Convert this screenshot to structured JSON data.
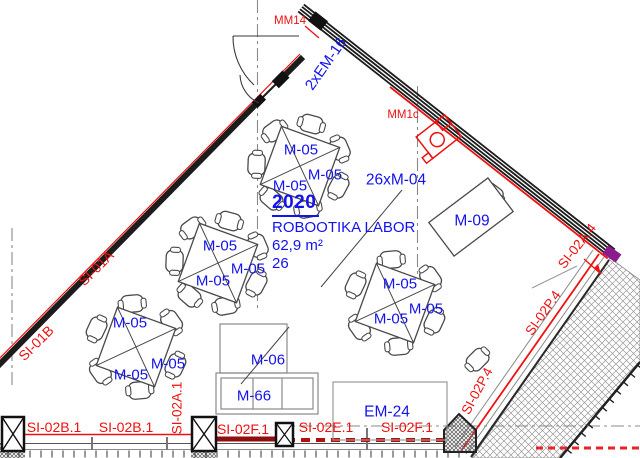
{
  "drawing": {
    "type": "architectural-floor-plan",
    "room": {
      "number": "2020",
      "name": "ROBOOTIKA LABOR",
      "area": "62,9 m²",
      "capacity": "26"
    }
  },
  "colors": {
    "annotation_blue": "#1313EE",
    "annotation_red": "#EE1111",
    "wall_dark": "#1c1c1c",
    "line_grey": "#777777",
    "dark_red": "#8F0F0F",
    "accent_purple": "#8E1B8E"
  },
  "labels": [
    {
      "text": "MM14",
      "x": 290,
      "y": 21,
      "r": 0,
      "s": 11.5,
      "c": "red"
    },
    {
      "text": "2xEM-16",
      "x": 326,
      "y": 64,
      "r": -55,
      "s": 15,
      "c": "blue"
    },
    {
      "text": "MM1c",
      "x": 403,
      "y": 115,
      "r": 0,
      "s": 11.5,
      "c": "red"
    },
    {
      "text": "26xM-04",
      "x": 396,
      "y": 180,
      "r": 0,
      "s": 15.5,
      "c": "blue"
    },
    {
      "text": "M-09",
      "x": 472,
      "y": 221,
      "r": 0,
      "s": 15.5,
      "c": "blue"
    },
    {
      "text": "M-05",
      "x": 301,
      "y": 150,
      "r": 0,
      "s": 15,
      "c": "blue"
    },
    {
      "text": "M-05",
      "x": 325,
      "y": 175,
      "r": 0,
      "s": 15,
      "c": "blue"
    },
    {
      "text": "M-05",
      "x": 290,
      "y": 186,
      "r": 0,
      "s": 15,
      "c": "blue"
    },
    {
      "text": "M-05",
      "x": 220,
      "y": 246,
      "r": 0,
      "s": 15,
      "c": "blue"
    },
    {
      "text": "M-05",
      "x": 248,
      "y": 269,
      "r": 0,
      "s": 15,
      "c": "blue"
    },
    {
      "text": "M-05",
      "x": 213,
      "y": 281,
      "r": 0,
      "s": 15,
      "c": "blue"
    },
    {
      "text": "M-05",
      "x": 130,
      "y": 323,
      "r": 0,
      "s": 15,
      "c": "blue"
    },
    {
      "text": "M-05",
      "x": 168,
      "y": 364,
      "r": 0,
      "s": 15,
      "c": "blue"
    },
    {
      "text": "M-05",
      "x": 131,
      "y": 375,
      "r": 0,
      "s": 15,
      "c": "blue"
    },
    {
      "text": "M-05",
      "x": 400,
      "y": 284,
      "r": 0,
      "s": 15,
      "c": "blue"
    },
    {
      "text": "M-05",
      "x": 426,
      "y": 309,
      "r": 0,
      "s": 15,
      "c": "blue"
    },
    {
      "text": "M-05",
      "x": 391,
      "y": 319,
      "r": 0,
      "s": 15,
      "c": "blue"
    },
    {
      "text": "M-06",
      "x": 268,
      "y": 360,
      "r": 0,
      "s": 15,
      "c": "blue"
    },
    {
      "text": "M-66",
      "x": 254,
      "y": 396,
      "r": 0,
      "s": 15,
      "c": "blue"
    },
    {
      "text": "EM-24",
      "x": 387,
      "y": 412,
      "r": 0,
      "s": 15.5,
      "c": "blue"
    },
    {
      "text": "SI-01A",
      "x": 96,
      "y": 268,
      "r": -45,
      "s": 14,
      "c": "red"
    },
    {
      "text": "SI-01B",
      "x": 36,
      "y": 343,
      "r": -45,
      "s": 14,
      "c": "red"
    },
    {
      "text": "SI-02A.4",
      "x": 577,
      "y": 246,
      "r": -52,
      "s": 13.5,
      "c": "red"
    },
    {
      "text": "SI-02P.4",
      "x": 543,
      "y": 313,
      "r": -55,
      "s": 13.5,
      "c": "red"
    },
    {
      "text": "SI-02P.4",
      "x": 477,
      "y": 391,
      "r": -62,
      "s": 13.5,
      "c": "red"
    },
    {
      "text": "SI-02A.1",
      "x": 177,
      "y": 408,
      "r": -90,
      "s": 13.5,
      "c": "red"
    },
    {
      "text": "SI-02B.1",
      "x": 54,
      "y": 427,
      "r": 0,
      "s": 14,
      "c": "red"
    },
    {
      "text": "SI-02B.1",
      "x": 126,
      "y": 427,
      "r": 0,
      "s": 14,
      "c": "red"
    },
    {
      "text": "SI-02F.1",
      "x": 243,
      "y": 429,
      "r": 0,
      "s": 14,
      "c": "red"
    },
    {
      "text": "SI-02E.1",
      "x": 326,
      "y": 427,
      "r": 0,
      "s": 14,
      "c": "red"
    },
    {
      "text": "SI-02F.1",
      "x": 407,
      "y": 427,
      "r": 0,
      "s": 14,
      "c": "red"
    }
  ],
  "furniture": {
    "group_tables": [
      {
        "id": "table-group-1",
        "cx": 300,
        "cy": 166,
        "rot": 20,
        "chairs": 7
      },
      {
        "id": "table-group-2",
        "cx": 218,
        "cy": 263,
        "rot": 20,
        "chairs": 7
      },
      {
        "id": "table-group-3",
        "cx": 136,
        "cy": 347,
        "rot": 20,
        "chairs": 6
      },
      {
        "id": "table-group-4",
        "cx": 395,
        "cy": 303,
        "rot": 20,
        "chairs": 6
      }
    ],
    "desk": {
      "cx": 471,
      "cy": 217,
      "rot": -37,
      "w": 74,
      "h": 42
    },
    "lone_chairs": [
      {
        "x": 478,
        "y": 360,
        "rot": -45
      },
      {
        "x": 492,
        "y": 193,
        "rot": 217
      }
    ]
  }
}
